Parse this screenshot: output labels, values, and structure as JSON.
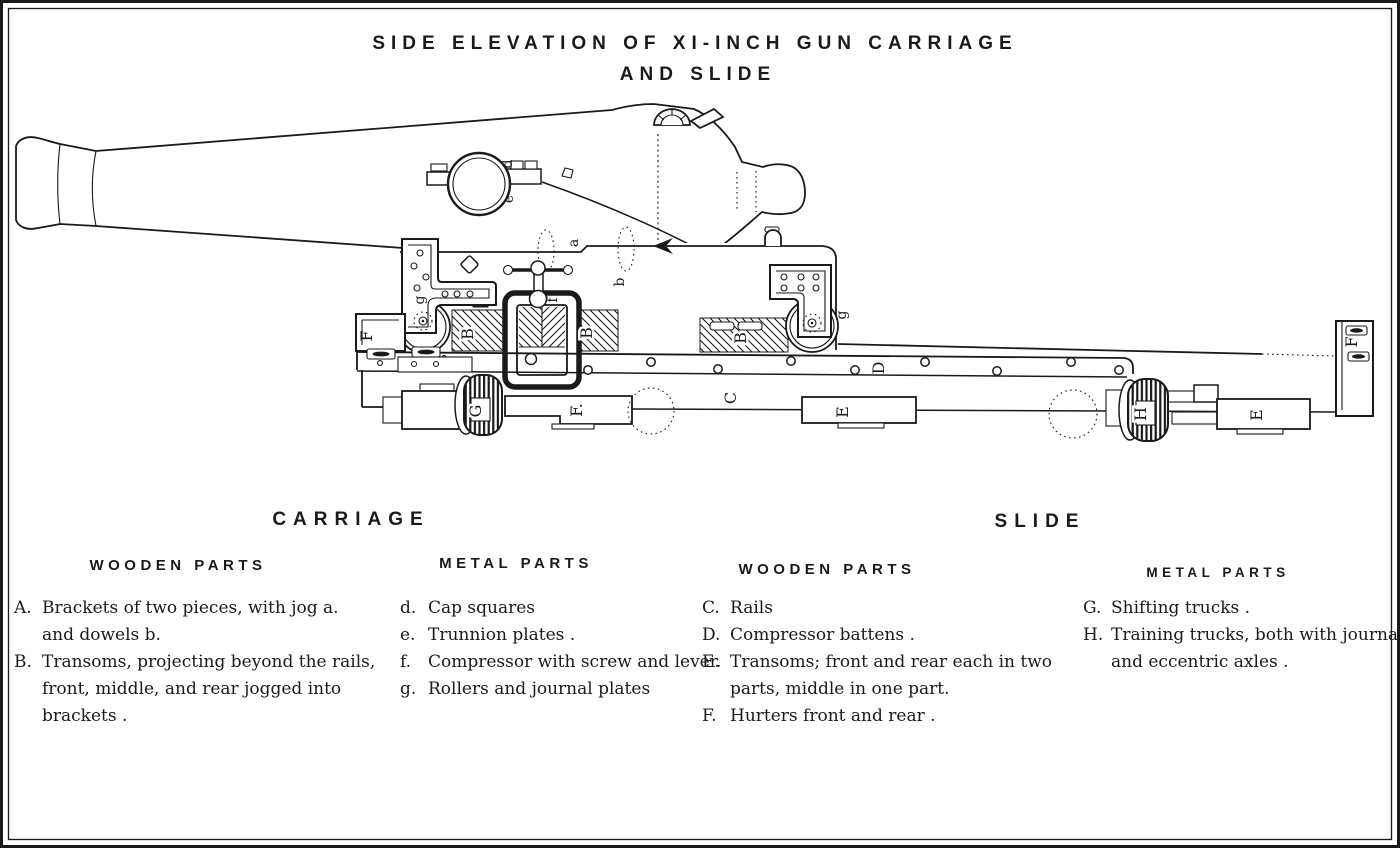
{
  "colors": {
    "ink": "#1a1a1a",
    "paper": "#ffffff"
  },
  "title": {
    "line1": "SIDE ELEVATION OF XI-INCH GUN CARRIAGE",
    "line2": "AND SLIDE"
  },
  "legend": {
    "carriage": {
      "heading": "CARRIAGE",
      "wooden": {
        "heading": "WOODEN PARTS",
        "items": [
          {
            "key": "A.",
            "lines": [
              "Brackets of two pieces, with jog  a.",
              "and dowels  b."
            ]
          },
          {
            "key": "B.",
            "lines": [
              "Transoms, projecting beyond the rails,",
              "front, middle, and rear jogged into",
              "brackets ."
            ]
          }
        ]
      },
      "metal": {
        "heading": "METAL PARTS",
        "items": [
          {
            "key": "d.",
            "lines": [
              "Cap squares"
            ]
          },
          {
            "key": "e.",
            "lines": [
              "Trunnion plates ."
            ]
          },
          {
            "key": "f.",
            "lines": [
              "Compressor with screw and lever."
            ]
          },
          {
            "key": "g.",
            "lines": [
              "Rollers and journal plates"
            ]
          }
        ]
      }
    },
    "slide": {
      "heading": "SLIDE",
      "wooden": {
        "heading": "WOODEN PARTS",
        "items": [
          {
            "key": "C.",
            "lines": [
              "Rails"
            ]
          },
          {
            "key": "D.",
            "lines": [
              "Compressor battens ."
            ]
          },
          {
            "key": "E.",
            "lines": [
              "Transoms; front and rear each in two",
              "parts, middle in one part."
            ]
          },
          {
            "key": "F.",
            "lines": [
              "Hurters front and rear ."
            ]
          }
        ]
      },
      "metal": {
        "heading": "METAL PARTS",
        "items": [
          {
            "key": "G.",
            "lines": [
              "Shifting trucks ."
            ]
          },
          {
            "key": "H.",
            "lines": [
              "Training trucks, both with journals",
              "and eccentric axles ."
            ]
          }
        ]
      }
    }
  },
  "part_labels": {
    "a": "a",
    "b": "b",
    "d": "d",
    "e": "e",
    "f": "f",
    "g": "g",
    "B": "B",
    "C": "C",
    "D": "D",
    "E": "E",
    "F": "F",
    "F_front": "F.",
    "G": "G",
    "H": "H"
  }
}
